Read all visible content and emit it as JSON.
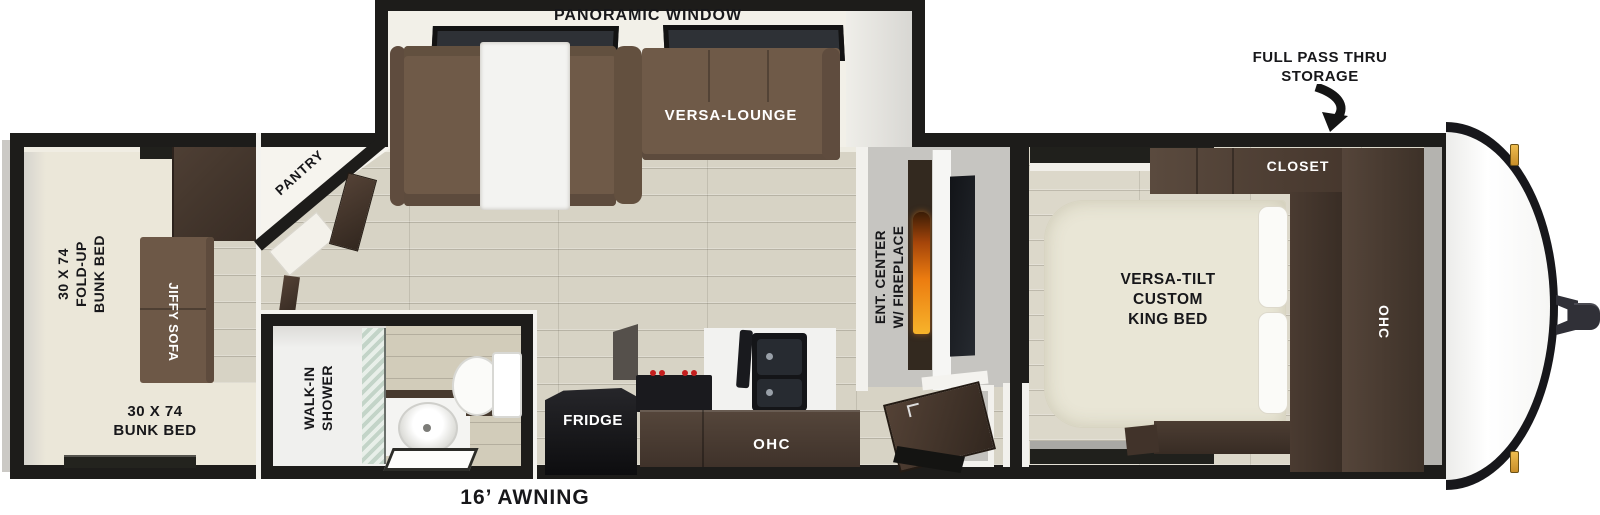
{
  "plan": {
    "slideout": {
      "panoramic_window": "PANORAMIC WINDOW",
      "versa_lounge": "VERSA-LOUNGE"
    },
    "bedroom": {
      "bed": "VERSA-TILT\nCUSTOM\nKING BED",
      "closet": "CLOSET",
      "ohc": "OHC"
    },
    "kitchen": {
      "fridge": "FRIDGE",
      "ohc": "OHC"
    },
    "living": {
      "ent_center": "ENT. CENTER\nW/ FIREPLACE",
      "pantry": "PANTRY"
    },
    "bath": {
      "shower": "WALK-IN\nSHOWER"
    },
    "bunk": {
      "foldup": "30 X 74\nFOLD-UP\nBUNK BED",
      "jiffy": "JIFFY SOFA",
      "bunkbed": "30 X 74\nBUNK BED"
    },
    "exterior": {
      "storage": "FULL PASS THRU\nSTORAGE",
      "awning": "16’ AWNING"
    },
    "colors": {
      "wall_black": "#1d1c1a",
      "floor_wood": "#d7d3c5",
      "sofa_brown": "#6f5a48",
      "cabinet_brown": "#46382e",
      "bed_cream": "#e9e6d6",
      "flame_orange": "#ec7c10",
      "wall_gray": "#c6c5c1",
      "marker_light": "#e0a83c"
    }
  }
}
